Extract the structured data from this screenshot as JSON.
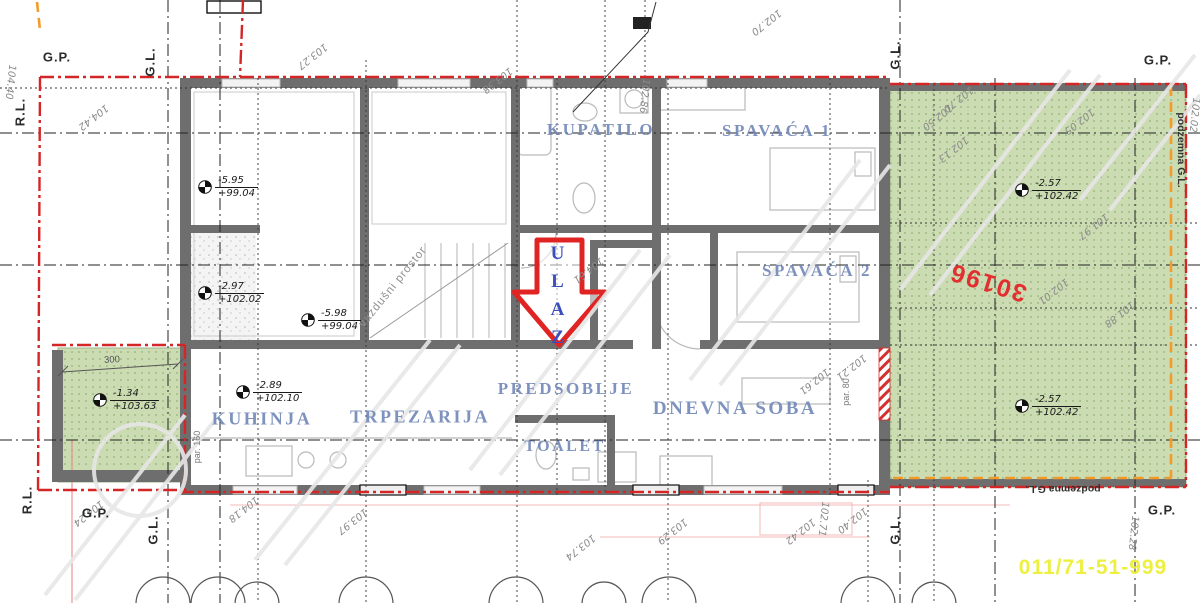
{
  "labels": {
    "entrance": "ULAZ",
    "air_space": "vazdušni prostor",
    "underground_line": "podzemna G.L.",
    "dim_300": "300",
    "par_160": "par. 160",
    "par_80": "par. 80"
  },
  "parcel_number": "30196",
  "phone": "011/71-51-999",
  "rooms": [
    {
      "label": "KUPATILO",
      "x": 601,
      "y": 130,
      "fs": 17
    },
    {
      "label": "SPAVAĆA 1",
      "x": 777,
      "y": 131,
      "fs": 17
    },
    {
      "label": "SPAVAĆA 2",
      "x": 817,
      "y": 271,
      "fs": 17
    },
    {
      "label": "PREDSOBLJE",
      "x": 566,
      "y": 389,
      "fs": 17
    },
    {
      "label": "KUHINJA",
      "x": 262,
      "y": 419,
      "fs": 18
    },
    {
      "label": "TRPEZARIJA",
      "x": 420,
      "y": 417,
      "fs": 18
    },
    {
      "label": "TOALET",
      "x": 565,
      "y": 447,
      "fs": 16
    },
    {
      "label": "DNEVNA SOBA",
      "x": 735,
      "y": 409,
      "fs": 19
    }
  ],
  "boundary_labels": [
    {
      "text": "G.P.",
      "x": 57,
      "y": 57,
      "rot": 0
    },
    {
      "text": "G.L.",
      "x": 150,
      "y": 62,
      "rot": -90
    },
    {
      "text": "R.L.",
      "x": 20,
      "y": 112,
      "rot": -90
    },
    {
      "text": "G.L.",
      "x": 895,
      "y": 55,
      "rot": -90
    },
    {
      "text": "G.P.",
      "x": 1158,
      "y": 60,
      "rot": 0
    },
    {
      "text": "R.L.",
      "x": 27,
      "y": 500,
      "rot": -90
    },
    {
      "text": "G.P.",
      "x": 96,
      "y": 513,
      "rot": 0
    },
    {
      "text": "G.L.",
      "x": 153,
      "y": 530,
      "rot": -90
    },
    {
      "text": "G.L.",
      "x": 895,
      "y": 530,
      "rot": -90
    },
    {
      "text": "G.P.",
      "x": 1162,
      "y": 510,
      "rot": 0
    }
  ],
  "elevation_markers": [
    {
      "rel": "-5.95",
      "abs": "+99.04",
      "x": 205,
      "y": 185
    },
    {
      "rel": "-2.97",
      "abs": "+102.02",
      "x": 205,
      "y": 291
    },
    {
      "rel": "-5.98",
      "abs": "+99.04",
      "x": 308,
      "y": 318
    },
    {
      "rel": "-2.89",
      "abs": "+102.10",
      "x": 243,
      "y": 390
    },
    {
      "rel": "-1.34",
      "abs": "+103.63",
      "x": 100,
      "y": 398
    },
    {
      "rel": "-2.57",
      "abs": "+102.42",
      "x": 1022,
      "y": 188
    },
    {
      "rel": "-2.57",
      "abs": "+102.42",
      "x": 1022,
      "y": 404
    }
  ],
  "dimension_labels": [
    {
      "text": "103.27",
      "x": 312,
      "y": 56,
      "rot": 142
    },
    {
      "text": "103.38",
      "x": 497,
      "y": 80,
      "rot": 142
    },
    {
      "text": "102.86",
      "x": 644,
      "y": 96,
      "rot": 96
    },
    {
      "text": "102.70",
      "x": 766,
      "y": 22,
      "rot": 142
    },
    {
      "text": "102.50",
      "x": 937,
      "y": 117,
      "rot": 142
    },
    {
      "text": "102.70",
      "x": 958,
      "y": 99,
      "rot": 142
    },
    {
      "text": "102.05",
      "x": 1079,
      "y": 121,
      "rot": 142
    },
    {
      "text": "102.13",
      "x": 953,
      "y": 149,
      "rot": 142
    },
    {
      "text": "102.02",
      "x": 1194,
      "y": 115,
      "rot": 96
    },
    {
      "text": "101.97",
      "x": 1093,
      "y": 226,
      "rot": 142
    },
    {
      "text": "102.01",
      "x": 1053,
      "y": 291,
      "rot": 142
    },
    {
      "text": "101.88",
      "x": 1119,
      "y": 314,
      "rot": 142
    },
    {
      "text": "104.42",
      "x": 93,
      "y": 117,
      "rot": 142
    },
    {
      "text": "104.40",
      "x": 10,
      "y": 82,
      "rot": 96
    },
    {
      "text": "104.61",
      "x": 588,
      "y": 270,
      "rot": 142
    },
    {
      "text": "102.21",
      "x": 851,
      "y": 367,
      "rot": 142
    },
    {
      "text": "102.61",
      "x": 814,
      "y": 381,
      "rot": 142
    },
    {
      "text": "104.24",
      "x": 88,
      "y": 513,
      "rot": 142
    },
    {
      "text": "104.18",
      "x": 243,
      "y": 509,
      "rot": 142
    },
    {
      "text": "103.97",
      "x": 352,
      "y": 521,
      "rot": 142
    },
    {
      "text": "103.74",
      "x": 580,
      "y": 547,
      "rot": 142
    },
    {
      "text": "103.29",
      "x": 672,
      "y": 531,
      "rot": 142
    },
    {
      "text": "102.71",
      "x": 823,
      "y": 519,
      "rot": 96
    },
    {
      "text": "102.42",
      "x": 800,
      "y": 531,
      "rot": 142
    },
    {
      "text": "102.40",
      "x": 852,
      "y": 520,
      "rot": 142
    },
    {
      "text": "102.28",
      "x": 1133,
      "y": 533,
      "rot": 96
    }
  ],
  "colors": {
    "boundary_red": "#d42626",
    "arrow_red": "#e02424",
    "room_label_blue": "#7187b8",
    "entrance_blue": "#3b50bd",
    "green_area": "#cbdcb2",
    "wall_gray": "#6e6e6e",
    "orange_line": "#f49b2b",
    "phone_yellow": "#eef041",
    "parcel_red": "#e23030"
  }
}
